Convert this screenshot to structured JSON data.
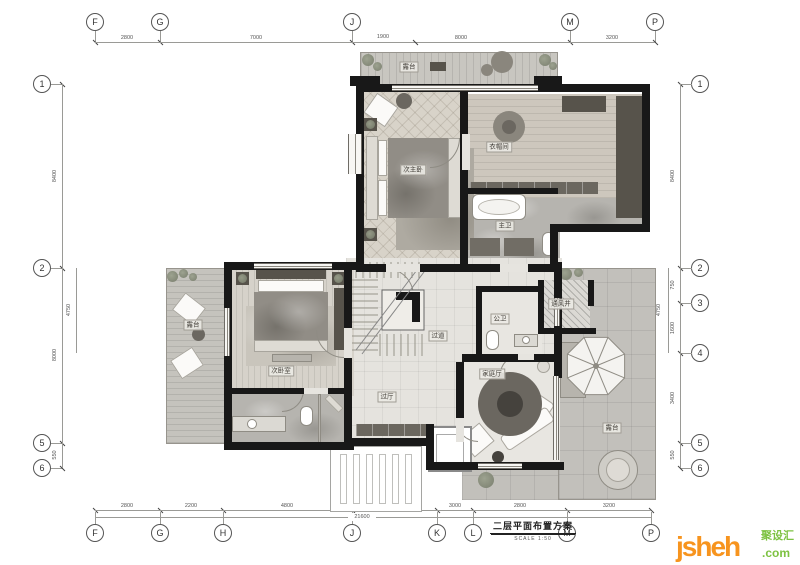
{
  "title": {
    "text": "二层平面布置方案",
    "scale": "SCALE  1:50"
  },
  "grid": {
    "top": {
      "bubbles": [
        "F",
        "G",
        "J",
        "M",
        "P"
      ],
      "dims": [
        "2800",
        "7000",
        "8000",
        "3200"
      ],
      "sub_dim": "1900"
    },
    "bottom": {
      "bubbles": [
        "F",
        "G",
        "H",
        "J",
        "K",
        "L",
        "M",
        "P"
      ],
      "dims": [
        "2800",
        "2200",
        "4800",
        "2800",
        "3000",
        "2800",
        "3200"
      ],
      "overall": "21600"
    },
    "left": {
      "bubbles": [
        "1",
        "2",
        "5",
        "6"
      ],
      "dims": [
        "8400",
        "8000",
        "550"
      ],
      "inner_dim": "4750"
    },
    "right": {
      "bubbles": [
        "1",
        "2",
        "3",
        "4",
        "5",
        "6"
      ],
      "dims": [
        "8400",
        "750",
        "1600",
        "3400",
        "550"
      ],
      "inner_dim": "4750"
    }
  },
  "rooms": {
    "terrace_top": "露台",
    "bedroom_second_master": "次主卧",
    "cloakroom": "衣帽间",
    "master_bath": "主卫",
    "bedroom_secondary": "次卧室",
    "terrace_left": "露台",
    "corridor": "过道",
    "guest_bath": "公卫",
    "vent_shaft": "通风井",
    "family_room": "家庭厅",
    "hallway": "过厅",
    "terrace_right": "露台"
  },
  "watermark": {
    "brand": "jsheh",
    "tld": ".com",
    "cn": "聚设汇"
  },
  "colors": {
    "wall": "#181818",
    "accent_orange": "#f7941e",
    "accent_green": "#7dc242"
  }
}
